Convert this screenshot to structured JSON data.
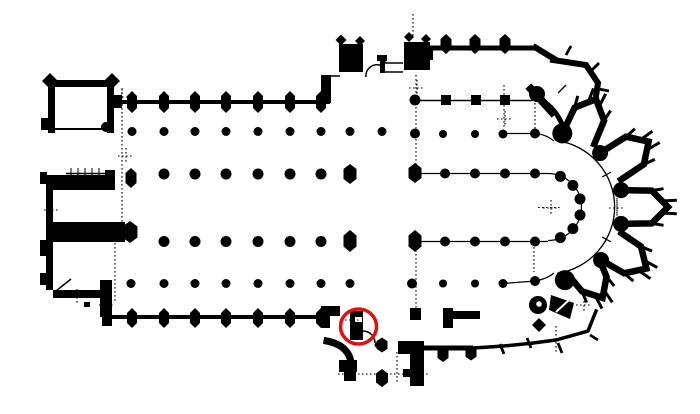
{
  "meta": {
    "drawing_type": "architectural floor plan",
    "subject": "gothic cathedral ground plan (nave with double aisles, twin west towers, transept, choir with ambulatory and radiating chapels)",
    "highlight_note": "red circle marking a pier at the west side of the south transept portal"
  },
  "colors": {
    "background": "#ffffff",
    "ink": "#000000",
    "highlight": "#dd1111"
  },
  "canvas": {
    "width": 700,
    "height": 414
  },
  "annotation": {
    "shape": "ellipse",
    "cx": 358.5,
    "cy": 326.5,
    "rx": 18,
    "ry": 17.5,
    "stroke_width": 3.5
  },
  "plan": {
    "rects": [
      [
        48,
        80,
        66,
        7
      ],
      [
        48,
        80,
        7,
        53
      ],
      [
        107,
        80,
        7,
        53
      ],
      [
        41,
        118,
        7,
        12
      ],
      [
        46,
        175,
        64,
        15
      ],
      [
        105,
        170,
        10,
        20
      ],
      [
        46,
        190,
        7,
        33
      ],
      [
        46,
        222,
        79,
        20
      ],
      [
        46,
        242,
        7,
        48
      ],
      [
        53,
        290,
        52,
        8
      ],
      [
        100,
        280,
        12,
        22
      ],
      [
        84,
        302,
        6,
        5
      ],
      [
        100,
        302,
        12,
        15
      ],
      [
        40,
        172,
        7,
        12
      ],
      [
        40,
        240,
        8,
        16
      ],
      [
        40,
        273,
        8,
        12
      ],
      [
        114,
        95,
        8,
        13
      ],
      [
        321,
        75,
        10,
        28
      ],
      [
        102,
        308,
        10,
        18
      ],
      [
        321,
        306,
        9,
        22
      ],
      [
        330,
        306,
        10,
        10
      ],
      [
        339,
        44,
        24,
        28
      ],
      [
        404,
        42,
        26,
        28
      ],
      [
        426,
        48,
        7,
        12
      ],
      [
        377,
        55,
        10,
        6
      ],
      [
        380,
        61,
        5,
        12
      ],
      [
        350,
        311,
        13,
        29
      ],
      [
        339,
        360,
        18,
        12
      ],
      [
        344,
        372,
        12,
        9
      ],
      [
        398,
        341,
        26,
        13
      ],
      [
        410,
        341,
        14,
        45
      ],
      [
        403,
        369,
        7,
        8
      ],
      [
        410,
        308,
        11,
        12
      ],
      [
        443,
        308,
        10,
        20
      ],
      [
        452,
        311,
        28,
        8
      ]
    ],
    "diamonds": [
      [
        50,
        81,
        16
      ],
      [
        112,
        81,
        16
      ],
      [
        341,
        40,
        11
      ],
      [
        360,
        41,
        10
      ],
      [
        409,
        37,
        10
      ],
      [
        426,
        39,
        10
      ],
      [
        539,
        325,
        14
      ]
    ],
    "squares": [
      [
        446,
        100,
        10
      ],
      [
        476,
        100,
        10
      ],
      [
        505,
        100,
        10
      ]
    ],
    "hexes": [
      [
        132,
        102,
        10,
        22
      ],
      [
        164,
        102,
        10,
        22
      ],
      [
        195,
        102,
        10,
        22
      ],
      [
        226,
        102,
        10,
        22
      ],
      [
        258,
        102,
        10,
        22
      ],
      [
        290,
        102,
        10,
        22
      ],
      [
        321,
        102,
        10,
        22
      ],
      [
        132,
        318,
        10,
        20
      ],
      [
        164,
        318,
        10,
        20
      ],
      [
        195,
        318,
        10,
        20
      ],
      [
        226,
        318,
        10,
        20
      ],
      [
        258,
        318,
        10,
        20
      ],
      [
        290,
        318,
        10,
        20
      ],
      [
        321,
        318,
        10,
        20
      ],
      [
        446,
        44,
        11,
        20
      ],
      [
        475,
        44,
        11,
        20
      ],
      [
        505,
        44,
        11,
        20
      ],
      [
        443,
        354,
        11,
        16
      ],
      [
        471,
        353,
        11,
        15
      ],
      [
        382,
        345,
        11,
        15
      ],
      [
        382,
        378,
        12,
        18
      ],
      [
        131,
        178,
        11,
        20
      ],
      [
        130,
        232,
        15,
        22
      ],
      [
        350,
        174,
        13,
        20
      ],
      [
        350,
        241,
        13,
        22
      ],
      [
        415,
        173,
        13,
        20
      ],
      [
        415,
        241,
        13,
        22
      ]
    ],
    "wall_lines": [
      [
        114,
        102,
        330,
        102,
        4
      ],
      [
        103,
        317,
        330,
        317,
        4
      ],
      [
        428,
        48,
        537,
        48,
        5
      ],
      [
        424,
        348,
        473,
        348,
        5
      ],
      [
        533,
        46,
        556,
        60,
        6
      ]
    ],
    "thick_paths": [
      {
        "d": "M553,60 L586,65 L598,83 L596,96",
        "w": 6
      },
      {
        "d": "M531,89 L552,112",
        "w": 8
      },
      {
        "d": "M539,99 Q556,107 564,129",
        "w": 5
      },
      {
        "d": "M327,341 C339,343 349,350 351,362 L351,372",
        "w": 7
      },
      {
        "d": "M473,348 Q515,346 556,340 L588,331 L596,311",
        "w": 3.5
      }
    ],
    "fill_paths": [
      {
        "d": "M551,295 L574,303 L570,319 L549,310 Z"
      }
    ],
    "ticks": [
      [
        500,
        344,
        504,
        354
      ],
      [
        527,
        338,
        531,
        348
      ],
      [
        558,
        343,
        562,
        353
      ],
      [
        590,
        335,
        598,
        340
      ],
      [
        566,
        55,
        571,
        46
      ],
      [
        592,
        70,
        599,
        63
      ],
      [
        599,
        89,
        609,
        91
      ]
    ],
    "thin_lines": [
      [
        55,
        129,
        102,
        129,
        2
      ],
      [
        66,
        173.5,
        105,
        173.5,
        1.5
      ],
      [
        71,
        168,
        71,
        179,
        1
      ],
      [
        78,
        168,
        78,
        179,
        1
      ],
      [
        85,
        168,
        85,
        179,
        1
      ],
      [
        92,
        168,
        92,
        179,
        1
      ],
      [
        99,
        168,
        99,
        179,
        1
      ],
      [
        330,
        76,
        340,
        76,
        1.5
      ],
      [
        385,
        63,
        403,
        63,
        1.4
      ],
      [
        385,
        57,
        385,
        63,
        1.2
      ],
      [
        383,
        72,
        403,
        72,
        1.4
      ],
      [
        415,
        100.5,
        533,
        100.5,
        1.5
      ],
      [
        505,
        133.5,
        535,
        133.5,
        1.2
      ],
      [
        415,
        173.5,
        548,
        173.5,
        1.2
      ],
      [
        415,
        241.5,
        548,
        241.5,
        1.2
      ],
      [
        503,
        283.5,
        535,
        281,
        1.2
      ],
      [
        56,
        291,
        71,
        279,
        1.5
      ],
      [
        558,
        93,
        566,
        85,
        1.3
      ]
    ],
    "thin_paths": [
      {
        "d": "M382,66 A11,11 0 0 0 366,77",
        "w": 1.5
      },
      {
        "d": "M363,331 A12,12 0 0 1 375,343",
        "w": 1.5
      },
      {
        "d": "M535,133 Q547,135 554,141",
        "w": 1.2
      },
      {
        "d": "M535,281 Q547,279 554,273",
        "w": 1.2
      }
    ],
    "dots": [
      [
        132,
        131.5,
        4.5
      ],
      [
        164,
        131.5,
        4.5
      ],
      [
        195,
        131.5,
        4.5
      ],
      [
        226,
        131.5,
        4.5
      ],
      [
        258,
        131.5,
        4.5
      ],
      [
        290,
        131.5,
        4.5
      ],
      [
        321,
        131.5,
        4.5
      ],
      [
        350,
        131.5,
        4.5
      ],
      [
        382,
        131.5,
        4.5
      ],
      [
        164,
        174,
        5.5
      ],
      [
        195,
        174,
        5.5
      ],
      [
        226,
        174,
        5.5
      ],
      [
        258,
        174,
        5.5
      ],
      [
        290,
        174,
        5.5
      ],
      [
        321,
        174,
        5.5
      ],
      [
        164,
        241.5,
        5.5
      ],
      [
        195,
        241.5,
        5.5
      ],
      [
        226,
        241.5,
        5.5
      ],
      [
        258,
        241.5,
        5.5
      ],
      [
        290,
        241.5,
        5.5
      ],
      [
        321,
        241.5,
        5.5
      ],
      [
        131,
        283.5,
        4.5
      ],
      [
        164,
        283.5,
        4.5
      ],
      [
        195,
        283.5,
        4.5
      ],
      [
        226,
        283.5,
        4.5
      ],
      [
        258,
        283.5,
        4.5
      ],
      [
        290,
        283.5,
        4.5
      ],
      [
        321,
        283.5,
        4.5
      ],
      [
        350,
        283.5,
        4.5
      ],
      [
        415,
        100,
        5.5
      ],
      [
        415,
        133.5,
        5
      ],
      [
        443,
        134,
        4
      ],
      [
        475,
        134,
        4
      ],
      [
        503,
        134,
        4.5
      ],
      [
        535,
        133.5,
        5
      ],
      [
        445,
        173.5,
        5
      ],
      [
        475,
        173.5,
        5
      ],
      [
        505,
        173.5,
        5
      ],
      [
        535,
        173.5,
        5
      ],
      [
        445,
        241.5,
        5
      ],
      [
        475,
        241.5,
        5
      ],
      [
        505,
        241.5,
        5
      ],
      [
        535,
        241.5,
        5
      ],
      [
        412,
        283.5,
        5
      ],
      [
        443,
        283.5,
        4
      ],
      [
        475,
        283.5,
        4
      ],
      [
        503,
        283.5,
        4.5
      ],
      [
        535,
        281,
        5
      ],
      [
        537,
        94,
        8
      ],
      [
        377,
        345,
        2.5
      ],
      [
        106,
        127,
        5
      ],
      [
        538,
        305,
        9
      ]
    ],
    "white_rects": [
      [
        355,
        317,
        7,
        5
      ]
    ],
    "white_circles": [
      [
        539,
        304,
        2.8
      ]
    ],
    "white_lines": [
      [
        556,
        312,
        569,
        300,
        2
      ]
    ],
    "dotted": [
      [
        122,
        88,
        122,
        225
      ],
      [
        115,
        243,
        115,
        303
      ],
      [
        416,
        75,
        416,
        168
      ],
      [
        416,
        246,
        416,
        310
      ],
      [
        413,
        14,
        413,
        36
      ],
      [
        397,
        352,
        397,
        384
      ],
      [
        338,
        374,
        430,
        374
      ],
      [
        535,
        103,
        535,
        135
      ],
      [
        534,
        247,
        534,
        272
      ],
      [
        504,
        85,
        504,
        128
      ],
      [
        556,
        326,
        556,
        352
      ],
      [
        617,
        186,
        617,
        226
      ],
      [
        538,
        207.5,
        562,
        207.5
      ],
      [
        345,
        320,
        360,
        320
      ]
    ],
    "crosses": [
      [
        122,
        97
      ],
      [
        126,
        156
      ],
      [
        52,
        210
      ],
      [
        107,
        305
      ],
      [
        417,
        88
      ],
      [
        505,
        119
      ],
      [
        551,
        208
      ],
      [
        617,
        208
      ],
      [
        77,
        297
      ],
      [
        584,
        305
      ]
    ],
    "apse": {
      "cx": 548,
      "cy": 207,
      "inner_dot_radius": 33,
      "inner_dot_angles": [
        -68,
        -41,
        -14,
        14,
        41,
        68
      ],
      "inner_dot_size": 5.5,
      "hemicycle_arc_radius": 33.5,
      "hemicycle_span": [
        -90,
        90
      ],
      "ambulatory_arc_radius": 67,
      "ambulatory_span": [
        -82,
        82
      ],
      "ambulatory_tick_angles": [
        -29,
        29
      ],
      "pier_ring_radius": 75,
      "pier_angles": [
        -79,
        -46,
        -13,
        13,
        45,
        77
      ],
      "pier_sizes": [
        10,
        8,
        8,
        8,
        8,
        10
      ],
      "chapels": [
        {
          "angle": -66,
          "apex": 118
        },
        {
          "angle": -33,
          "apex": 120
        },
        {
          "angle": 0,
          "apex": 120
        },
        {
          "angle": 32,
          "apex": 116
        },
        {
          "angle": 59,
          "apex": 106
        }
      ],
      "chapel_mouth_radius": 75,
      "chapel_stroke": 6.5
    }
  }
}
